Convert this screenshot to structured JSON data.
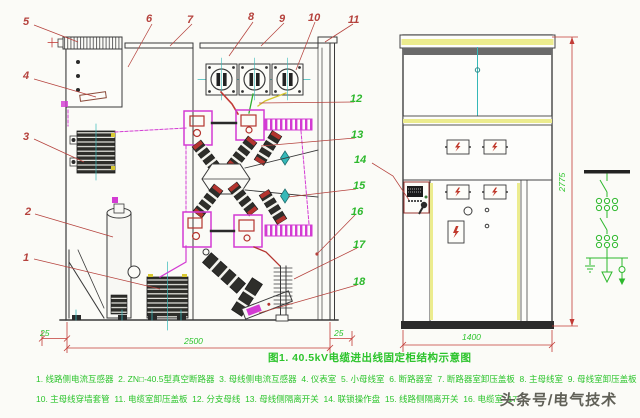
{
  "caption": "图1. 40.5kV电缆进出线固定柜结构示意图",
  "callouts": [
    "1",
    "2",
    "3",
    "4",
    "5",
    "6",
    "7",
    "8",
    "9",
    "10",
    "11",
    "12",
    "13",
    "14",
    "15",
    "16",
    "17",
    "18"
  ],
  "dimensions": {
    "left_margin": "25",
    "cabinet_depth": "2500",
    "right_margin": "25",
    "cabinet_width": "1400",
    "cabinet_height": "2775"
  },
  "legend": {
    "line1": "1. 线路侧电流互感器  2. ZN□-40.5型真空断路器  3. 母线侧电流互感器  4. 仪表室  5. 小母线室  6. 断路器室  7. 断路器室卸压盖板  8. 主母线室  9. 母线室卸压盖板",
    "line2": "10. 主母线穿墙套管  11. 电缆室卸压盖板  12. 分支母线  13. 母线侧隔离开关  14. 联锁操作盘  15. 线路侧隔离开关  16. 电缆室  17."
  },
  "watermark": "头条号/电气技术"
}
